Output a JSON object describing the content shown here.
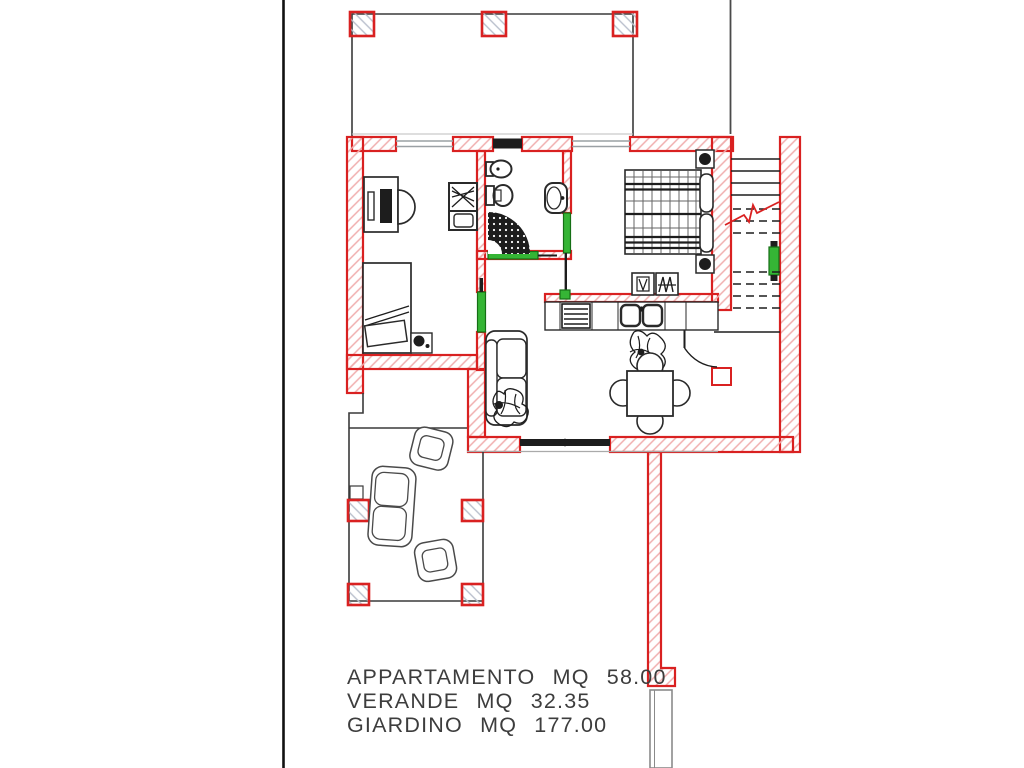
{
  "page": {
    "type": "architectural-floor-plan",
    "background": "#ffffff"
  },
  "colors": {
    "wall": "#d92121",
    "wall_hatch": "#f0aeae",
    "pillar_hatch": "#b9bfcc",
    "door": "#35b535",
    "door_dark": "#156f15",
    "line": "#1d1d1d",
    "furniture": "#2a2a2a",
    "glass": "#9aa0a4",
    "text": "#3d3d3d",
    "background": "#ffffff"
  },
  "area_summary": {
    "rows": [
      {
        "name": "APPARTAMENTO",
        "unit": "MQ",
        "value": "58.00",
        "line": "APPARTAMENTO MQ 58.00"
      },
      {
        "name": "VERANDE",
        "unit": "MQ",
        "value": "32.35",
        "line": "VERANDE MQ 32.35"
      },
      {
        "name": "GIARDINO",
        "unit": "MQ",
        "value": "177.00",
        "line": "GIARDINO MQ 177.00"
      }
    ]
  }
}
